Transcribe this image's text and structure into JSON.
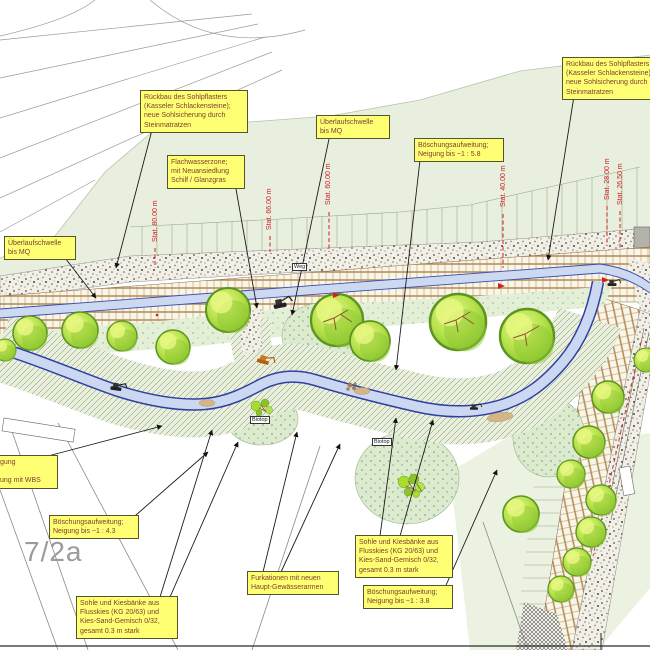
{
  "callouts": {
    "rueckbau_links": {
      "text": "Rückbau des Sohlpflasters\n(Kasseler Schlackensteine);\nneue Sohlsicherung durch\nSteinmatratzen"
    },
    "rueckbau_rechts": {
      "text": "Rückbau des Sohlpflasters\n(Kasseler Schlackensteine);\nneue Sohlsicherung durch\nSteinmatratzen"
    },
    "ueberlaufschwelle_oben": {
      "text": "Überlaufschwelle\nbis MQ"
    },
    "ueberlaufschwelle_links": {
      "text": "Überlaufschwelle\nbis MQ"
    },
    "flachwasserzone": {
      "text": "Flachwasserzone;\nmit Neuansiedlung\nSchilf / Glanzgras"
    },
    "boeschung_58": {
      "text": "Böschungsaufweitung;\nNeigung bis ~1 : 5.8"
    },
    "boeschung_43": {
      "text": "Böschungsaufweitung;\nNeigung bis ~1 : 4.3"
    },
    "boeschung_38": {
      "text": "Böschungsaufweitung;\nNeigung bis ~1 : 3.8"
    },
    "sohle_links": {
      "text": "Sohle und Kiesbänke aus\nFlusskies (KG 20/63) und\nKies-Sand-Gemisch 0/32,\ngesamt 0.3 m stark"
    },
    "sohle_rechts": {
      "text": "Sohle und Kiesbänke aus\nFlusskies (KG 20/63) und\nKies-Sand-Gemisch 0/32,\ngesamt 0.3 m stark"
    },
    "furkationen": {
      "text": "Furkationen mit neuen\nHaupt-Gewässerarmen"
    },
    "wbs_clipped": {
      "text": "gung\n\nung mit WBS"
    }
  },
  "stations": [
    {
      "label": "Stat. 80.00 m"
    },
    {
      "label": "Stat. 66.00 m"
    },
    {
      "label": "Stat. 60.00 m"
    },
    {
      "label": "Stat. 40.00 m"
    },
    {
      "label": "Stat. 28.00 m"
    },
    {
      "label": "Stat. 26.50 m"
    }
  ],
  "map_labels": {
    "parcel": "7/2a",
    "weg": "Weg",
    "biotop_1": "Biotop",
    "biotop_2": "Biotop"
  },
  "colors": {
    "callout_bg": "#ffff73",
    "callout_text": "#7b4030",
    "station_red": "#cc2222",
    "water_blue": "#3140a0",
    "water_fill": "#ccd8f1",
    "tree_green": "#9ed23c",
    "pale_green": "#e9efdf",
    "pond_green": "#dcebd0",
    "brick_tan": "#b28a52"
  }
}
